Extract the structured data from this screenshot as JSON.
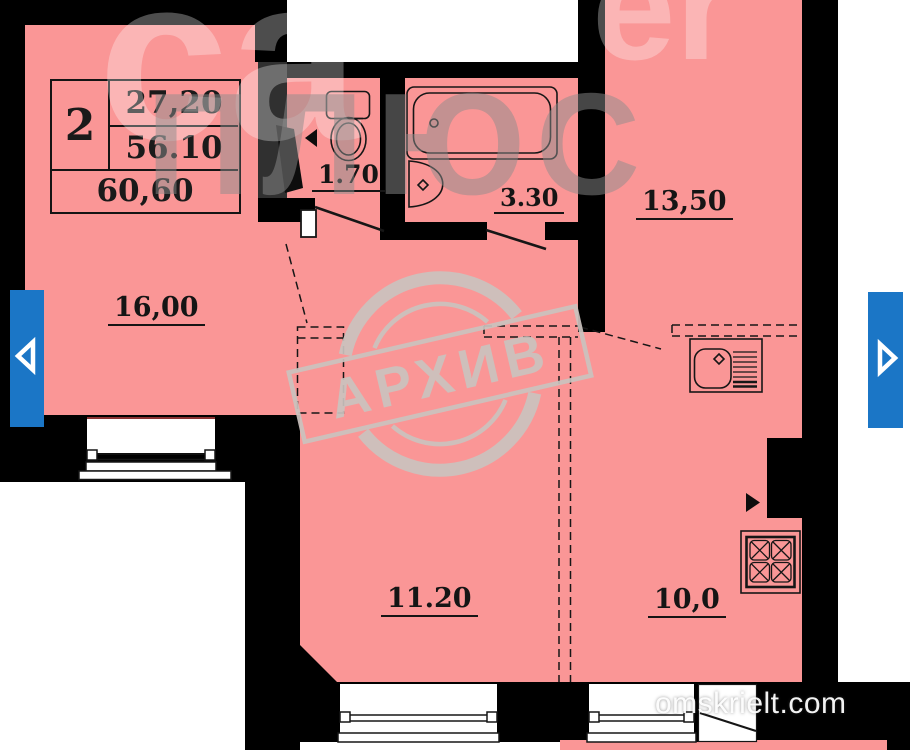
{
  "page": {
    "site_watermark": "omskrielt.com"
  },
  "watermarks": {
    "top_left_fragment": "ca",
    "top_right_fragment": "er",
    "agency_fragment": "ПЛЮС",
    "stamp_text": "АРХИВ"
  },
  "info_table": {
    "rooms_count": "2",
    "area_living": "27,20",
    "area_secondary": "56.10",
    "area_total": "60,60"
  },
  "rooms": {
    "living_16": {
      "area": "16,00"
    },
    "wc": {
      "area": "1.70"
    },
    "bathroom": {
      "area": "3.30"
    },
    "room_13_5": {
      "area": "13,50"
    },
    "room_11_2": {
      "area": "11.20"
    },
    "kitchen_10": {
      "area": "10,0"
    }
  },
  "icons": {
    "prev": "left-arrow",
    "next": "right-arrow"
  },
  "colors": {
    "room_fill": "#FA9696",
    "wall": "#000000",
    "nav_blue": "#1B76C6",
    "stamp_gray": "#CBC3BF"
  }
}
